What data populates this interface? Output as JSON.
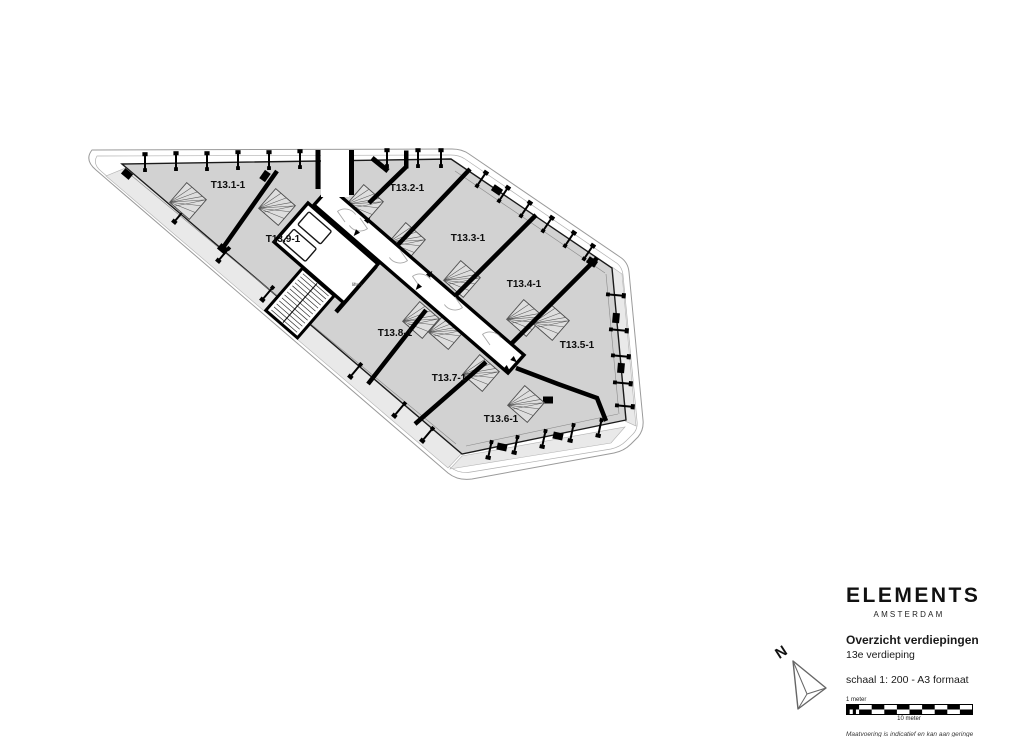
{
  "drawing": {
    "units": [
      {
        "label": "T13.1-1",
        "x": 228,
        "y": 188
      },
      {
        "label": "T13.9-1",
        "x": 283,
        "y": 242
      },
      {
        "label": "T13.2-1",
        "x": 407,
        "y": 191
      },
      {
        "label": "T13.3-1",
        "x": 468,
        "y": 241
      },
      {
        "label": "T13.4-1",
        "x": 524,
        "y": 287
      },
      {
        "label": "T13.5-1",
        "x": 577,
        "y": 348
      },
      {
        "label": "T13.8-1",
        "x": 395,
        "y": 336
      },
      {
        "label": "T13.7-1",
        "x": 449,
        "y": 381
      },
      {
        "label": "T13.6-1",
        "x": 501,
        "y": 422
      }
    ],
    "core_label": "liften",
    "north_label": "N"
  },
  "title_block": {
    "brand": "ELEMENTS",
    "brand_subtitle": "AMSTERDAM",
    "title": "Overzicht verdiepingen",
    "floor": "13e verdieping",
    "scale_note": "schaal 1: 200 - A3 formaat",
    "scalebar": {
      "label_top": "1 meter",
      "label_bottom": "10 meter"
    },
    "disclaimer": [
      "Maatvoering is indicatief en kan aan geringe",
      "afwijkingen onderhevig zijn. Aan deze tekening",
      "kunnen geen rechten worden ontleend"
    ]
  },
  "colors": {
    "floor_plate": "#d2d2d2",
    "balcony": "#e9e9e9",
    "walls": "#000000",
    "outline": "#9a9a9a",
    "ink": "#1a1a1a"
  }
}
